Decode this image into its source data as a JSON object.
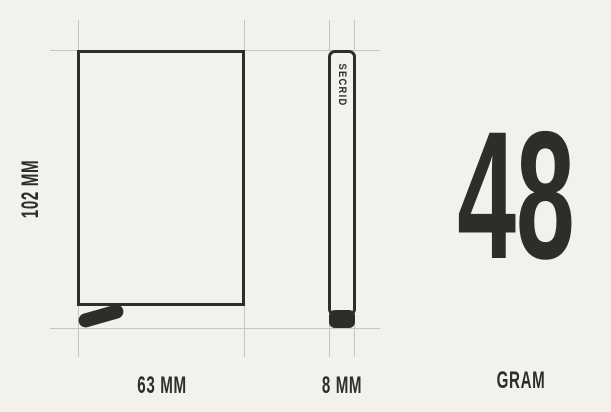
{
  "colors": {
    "background": "#f2f1ec",
    "ink": "#2e2d28",
    "guide_line": "#c6c5bf"
  },
  "diagram": {
    "front_view": {
      "height_label": "102 MM",
      "width_label": "63 MM"
    },
    "side_view": {
      "brand_label": "SECRID",
      "width_label": "8 MM"
    },
    "weight": {
      "value": "48",
      "unit_label": "GRAM"
    }
  }
}
